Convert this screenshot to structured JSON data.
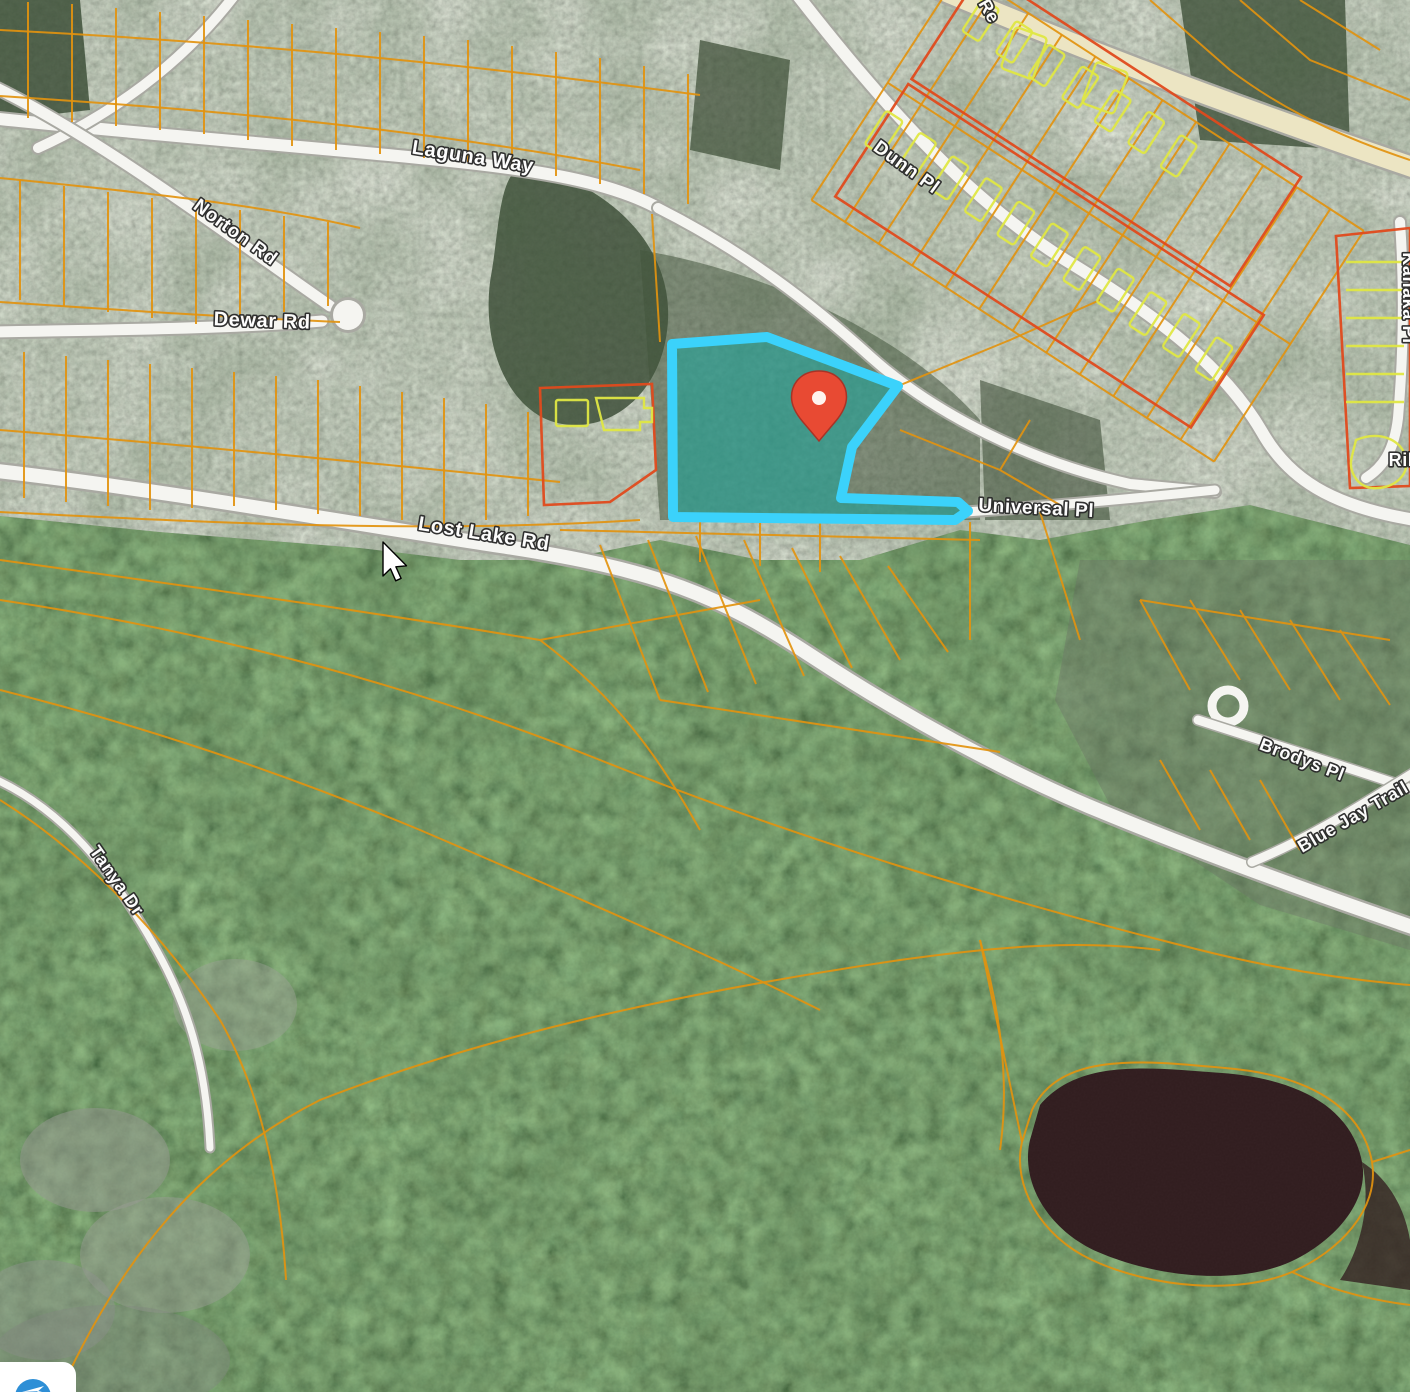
{
  "map": {
    "type": "satellite-parcel-view",
    "road_labels": [
      {
        "id": "laguna-way",
        "text": "Laguna Way",
        "x": 472,
        "y": 163,
        "rotate": 9,
        "size": 20
      },
      {
        "id": "dunn-pl",
        "text": "Dunn Pl",
        "x": 903,
        "y": 172,
        "rotate": 36,
        "size": 19
      },
      {
        "id": "norton-rd",
        "text": "Norton Rd",
        "x": 232,
        "y": 237,
        "rotate": 36,
        "size": 19
      },
      {
        "id": "dewar-rd",
        "text": "Dewar Rd",
        "x": 262,
        "y": 327,
        "rotate": 2,
        "size": 20
      },
      {
        "id": "lost-lake-rd",
        "text": "Lost Lake Rd",
        "x": 483,
        "y": 540,
        "rotate": 9,
        "size": 20
      },
      {
        "id": "universal-pl",
        "text": "Universal Pl",
        "x": 1036,
        "y": 514,
        "rotate": 3,
        "size": 19
      },
      {
        "id": "kanaka-pl",
        "text": "Kanaka Pl",
        "x": 1403,
        "y": 298,
        "rotate": 90,
        "size": 18
      },
      {
        "id": "ril-partial",
        "text": "Ril",
        "x": 1401,
        "y": 466,
        "rotate": 0,
        "size": 18
      },
      {
        "id": "brodys-pl",
        "text": "Brodys Pl",
        "x": 1300,
        "y": 765,
        "rotate": 21,
        "size": 18
      },
      {
        "id": "blue-jay-trail",
        "text": "Blue Jay Trail",
        "x": 1356,
        "y": 822,
        "rotate": -30,
        "size": 18
      },
      {
        "id": "tanya-dr",
        "text": "Tanya Dr",
        "x": 112,
        "y": 884,
        "rotate": 55,
        "size": 18
      },
      {
        "id": "re-partial",
        "text": "Re",
        "x": 984,
        "y": 14,
        "rotate": 60,
        "size": 18
      }
    ],
    "highlighted_parcel": {
      "label": "selected-property-boundary",
      "stroke_color": "#3BD2FB",
      "fill_color": "#18A89F"
    },
    "marker": {
      "label": "property-location-pin",
      "color": "#E84A33"
    },
    "cursor": {
      "type": "arrow-pointer"
    },
    "badge": {
      "label": "map-logo-badge",
      "color": "#2E8FD6"
    },
    "colors": {
      "parcel_line": "#E2930F",
      "building_outline": "#DFE743",
      "block_outline": "#E04A1C",
      "road_fill": "#F5F5F1",
      "main_road_tint": "#ECE5C3",
      "forest": "#32432B",
      "lake": "#2A1517"
    }
  }
}
